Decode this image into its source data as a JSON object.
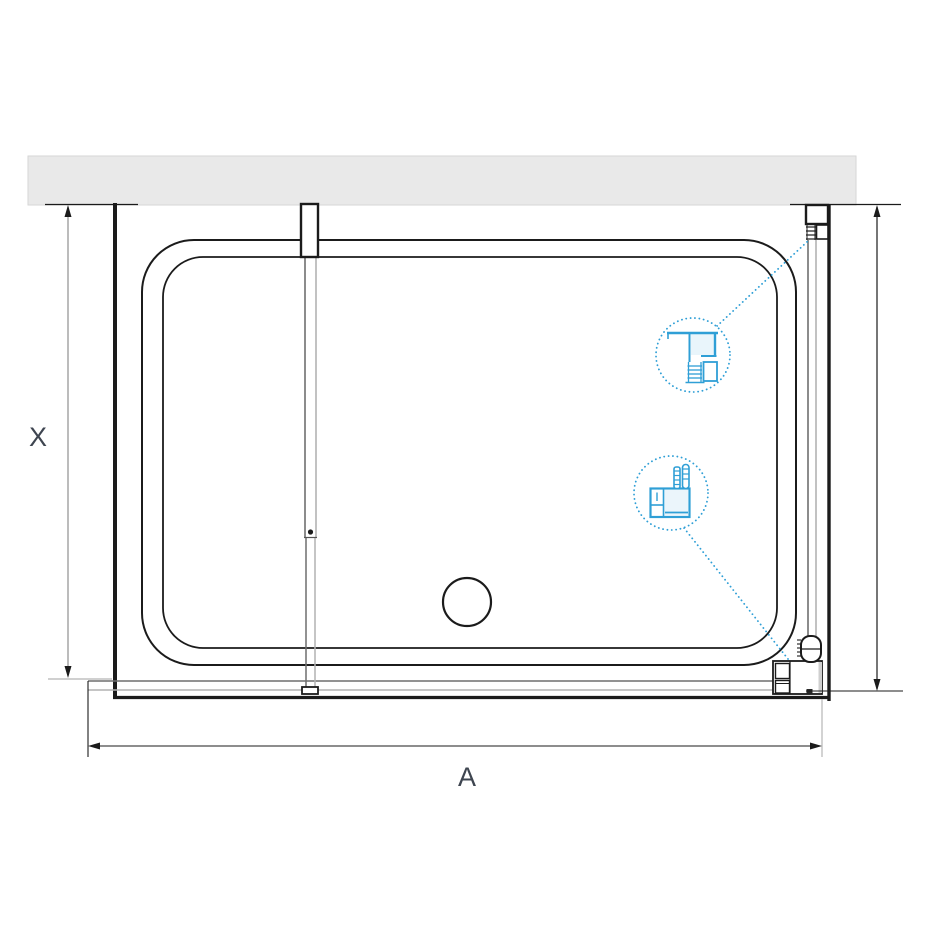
{
  "diagram": {
    "type": "technical-drawing",
    "view": "top-view-shower-enclosure",
    "labels": {
      "depth_dimension": "X",
      "width_dimension": "A"
    },
    "callouts": [
      {
        "icon": "wall-profile-detail-icon",
        "style": "dotted-circle"
      },
      {
        "icon": "floor-support-detail-icon",
        "style": "dotted-circle"
      }
    ]
  },
  "colors": {
    "wall_fill": "#e9e9e9",
    "wall_edge": "#d6d6d6",
    "ink": "#1b1b1b",
    "glass_dark": "#6f6f6f",
    "glass_light": "#b2b2b2",
    "dim_gray": "#8f8f8f",
    "ext_gray": "#b5b5b5",
    "accent_blue": "#2f9fd6",
    "accent_blue_light": "#d7ecf8",
    "label_color": "#3e4550"
  }
}
